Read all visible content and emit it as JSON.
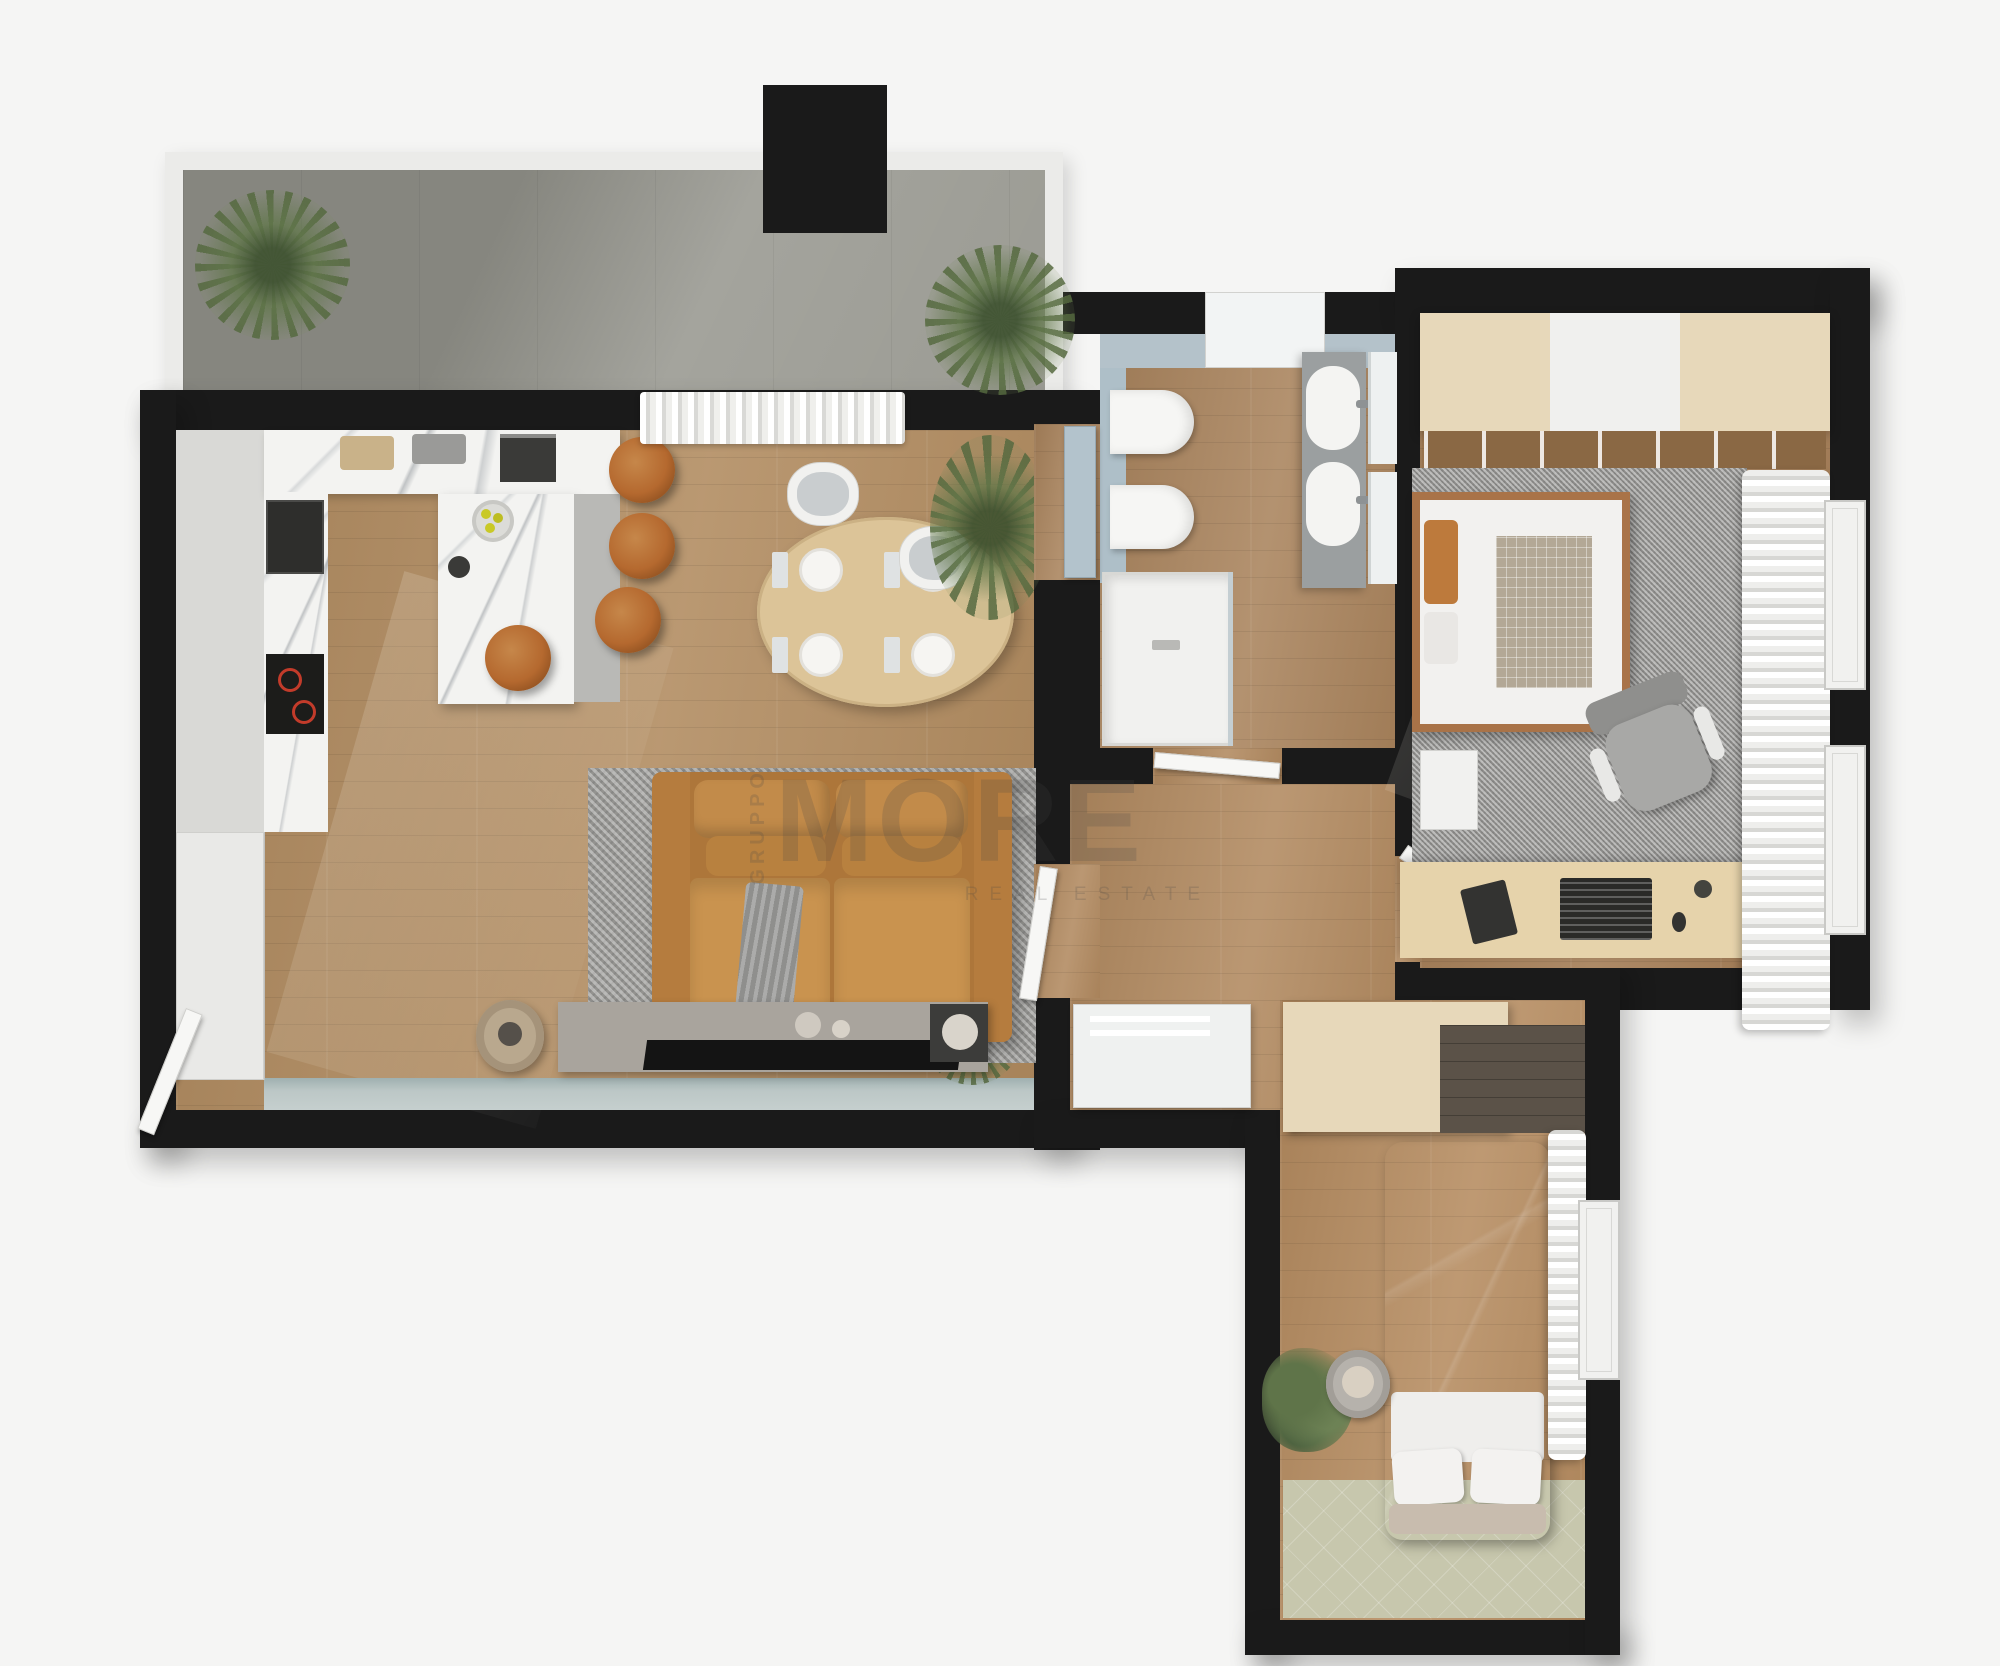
{
  "watermark": {
    "vertical_label": "GRUPPO",
    "main_label": "MORE",
    "sub_label": "REAL ESTATE"
  },
  "palette": {
    "background": "#f5f5f4",
    "wall": "#1a1a1a",
    "wood_floor": "#b08a5e",
    "balcony_concrete": "#95958d",
    "marble_counter": "#f3f3f1",
    "accent_blue": "#aebfc8",
    "window_band": "#bcc7c6",
    "sofa_tan": "#c08747",
    "stool_cognac": "#b5692f",
    "rug_gray": "#a09f9c",
    "rug_sage": "#c7c7ad",
    "wardrobe_wood": "#e7d8ba",
    "bed2_upholstery": "#7b7168",
    "plant_green": "#5f7449"
  },
  "rooms": [
    {
      "id": "balcony",
      "furniture": [
        "railing",
        "potted-palm-left",
        "potted-palm-right"
      ]
    },
    {
      "id": "living-kitchen",
      "furniture": [
        "kitchen-cabinets",
        "oven",
        "cooktop",
        "coffee-machine",
        "kitchen-island",
        "bar-stools",
        "dining-table",
        "dining-chairs",
        "plates",
        "sofa",
        "area-rug",
        "tv-sideboard",
        "tv",
        "side-table",
        "plants",
        "balcony-curtain",
        "storage-column",
        "window-band"
      ]
    },
    {
      "id": "bathroom",
      "furniture": [
        "toilet",
        "bidet",
        "double-vanity",
        "sinks",
        "mirrors",
        "shower",
        "blue-door"
      ]
    },
    {
      "id": "bedroom-1",
      "furniture": [
        "wardrobe",
        "double-bed",
        "rug",
        "nightstand",
        "desk",
        "laptop",
        "office-chair",
        "curtains",
        "windows"
      ]
    },
    {
      "id": "hallway",
      "furniture": [
        "sideboard",
        "doors"
      ]
    },
    {
      "id": "bedroom-2",
      "furniture": [
        "wardrobe",
        "upholstered-bed",
        "pillows",
        "round-chair",
        "plant",
        "sage-rug",
        "curtain",
        "window"
      ]
    }
  ]
}
